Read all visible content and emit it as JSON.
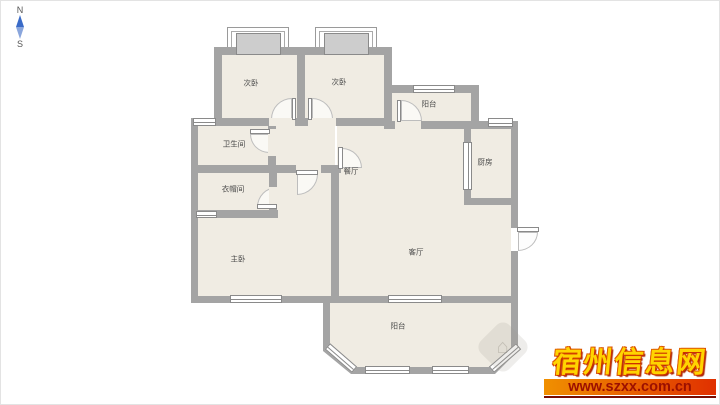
{
  "compass": {
    "north": "N",
    "south": "S"
  },
  "rooms": [
    {
      "name": "bedroom-left",
      "label": "次卧"
    },
    {
      "name": "bedroom-right",
      "label": "次卧"
    },
    {
      "name": "balcony-top",
      "label": "阳台"
    },
    {
      "name": "kitchen",
      "label": "厨房"
    },
    {
      "name": "bathroom",
      "label": "卫生间"
    },
    {
      "name": "cloakroom",
      "label": "衣帽间"
    },
    {
      "name": "dining-room",
      "label": "餐厅"
    },
    {
      "name": "living-room",
      "label": "客厅"
    },
    {
      "name": "master-bedroom",
      "label": "主卧"
    },
    {
      "name": "balcony-bottom",
      "label": "阳台"
    }
  ],
  "watermark": {
    "site_name": "宿州信息网",
    "url": "www.szxx.com.cn",
    "title_color": "#ffd400",
    "bar_gradient": [
      "#f09000",
      "#e03000"
    ],
    "url_color": "#9c1000"
  },
  "plan_colors": {
    "wall": "#a4a4a4",
    "floor": "#f0ece3",
    "window_border": "#8a8a8a",
    "compass_needle": "#3a6bc8"
  }
}
